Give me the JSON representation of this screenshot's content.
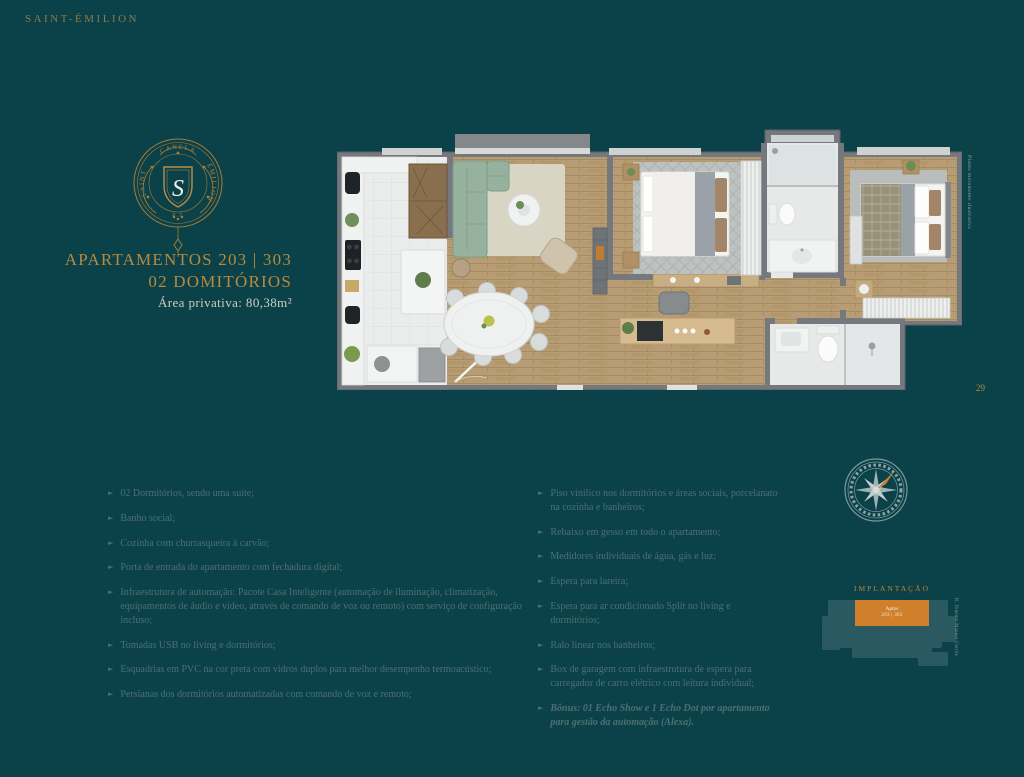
{
  "brand": {
    "name": "SAINT-ÉMILION"
  },
  "crest": {
    "top_text": "CANELA",
    "left_text": "SAINT",
    "right_text": "ÉMILION",
    "bottom_text": "8.5",
    "monogram": "S"
  },
  "title": {
    "line1": "APARTAMENTOS 203 | 303",
    "line2": "02 DOMITÓRIOS",
    "area": "Área privativa: 80,38m²"
  },
  "floorplan": {
    "disclaimer": "Planta meramente ilustrativa"
  },
  "features_left": [
    {
      "text": "02 Dormitórios, sendo uma suíte;"
    },
    {
      "text": "Banho social;"
    },
    {
      "text": "Cozinha com churrasqueira à carvão;"
    },
    {
      "text": "Porta de entrada do apartamento com fechadura digital;"
    },
    {
      "text": "Infraestrutura de automação: Pacote Casa Inteligente (automação de iluminação, climatização, equipamentos de áudio e vídeo, através de comando de voz ou remoto) com serviço de configuração incluso;"
    },
    {
      "text": "Tomadas USB no living e dormitórios;"
    },
    {
      "text": "Esquadrias em PVC na cor preta com vidros duplos para melhor desempenho termoacústico;"
    },
    {
      "text": "Persianas dos dormitórios automatizadas com comando de voz e remoto;"
    }
  ],
  "features_right": [
    {
      "text": "Piso vinílico nos dormitórios e áreas sociais, porcelanato na cozinha e banheiros;"
    },
    {
      "text": "Rebaixo em gesso em todo o apartamento;"
    },
    {
      "text": "Medidores individuais de água, gás e luz;"
    },
    {
      "text": "Espera para lareira;"
    },
    {
      "text": "Espera para ar condicionado Split no living e dormitórios;"
    },
    {
      "text": "Ralo linear nos banheiros;"
    },
    {
      "text": "Box de garagem com infraestrutura de espera para carregador de carro elétrico com leitura individual;"
    },
    {
      "text": "Bônus: 01 Echo Show e 1 Echo Dot por apartamento para gestão da automação (Alexa).",
      "bold": true
    }
  ],
  "implantacao": {
    "label": "IMPLANTAÇÃO",
    "unit_line1": "Aptos",
    "unit_line2": "203 | 303",
    "street": "R. Tenente Manoel Corrêa"
  },
  "page_number": "29",
  "colors": {
    "background": "#0b4249",
    "gold": "#b78a3e",
    "body_text": "#4d6f73",
    "orange_accent": "#d0802a",
    "wall_gray": "#75797d",
    "wood_floor": "#b79c74",
    "sofa_green": "#96b29e"
  }
}
